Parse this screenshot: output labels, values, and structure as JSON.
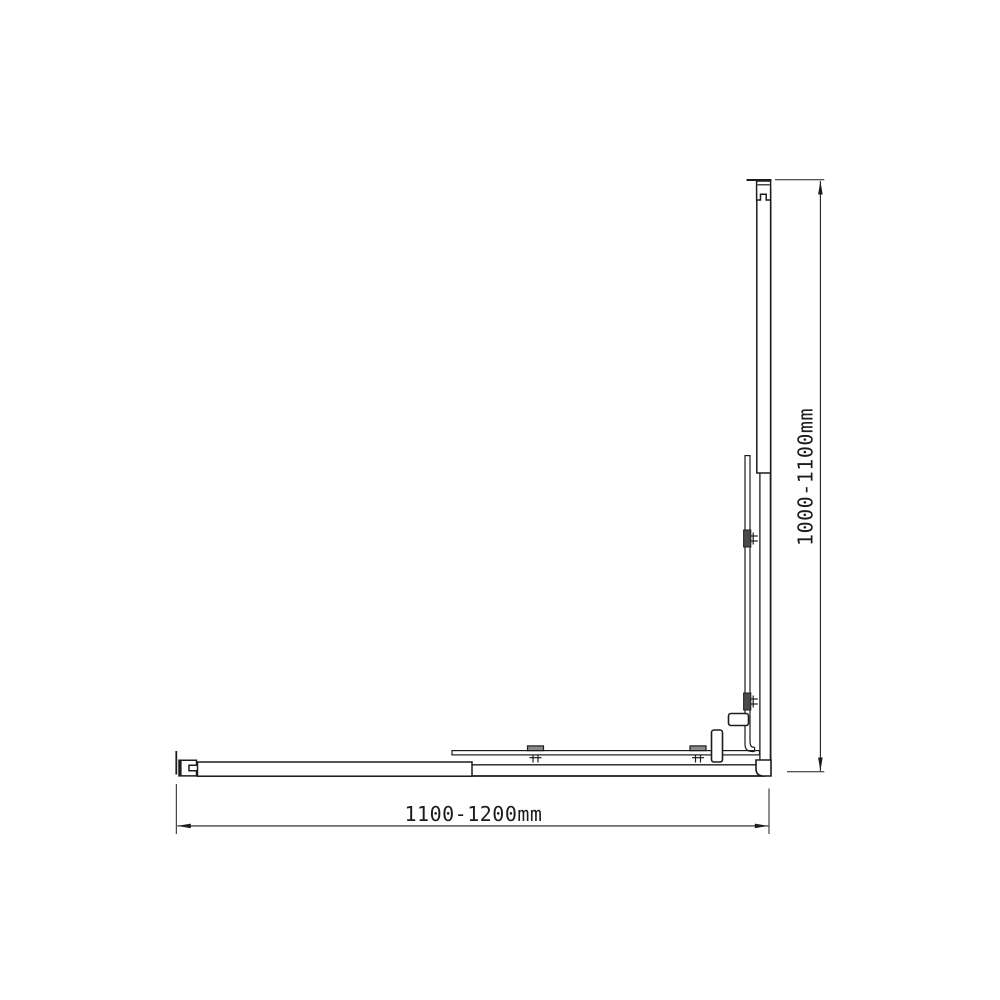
{
  "drawing": {
    "background_color": "#ffffff",
    "line_color": "#1c1c1c",
    "roller_cap_color": "#8a8a8a",
    "clamp_color": "#4a4a4a"
  },
  "dimensions": {
    "width_label": "1100-1200mm",
    "height_label": "1000-1100mm"
  }
}
